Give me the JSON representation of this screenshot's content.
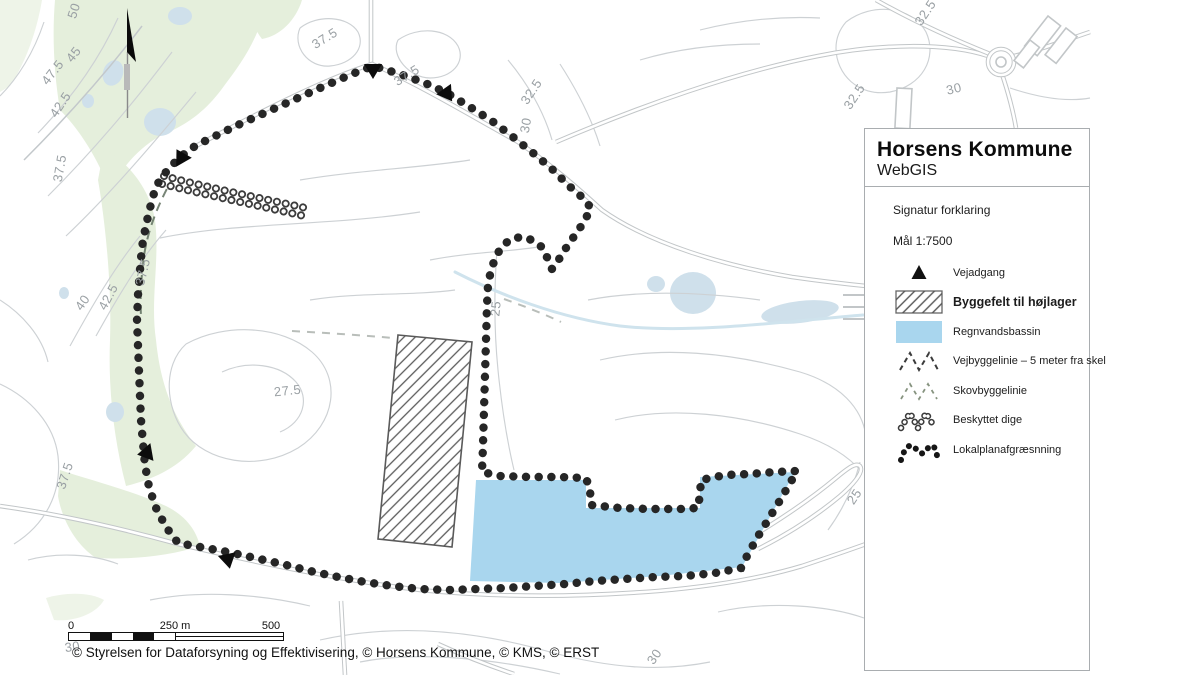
{
  "brand": {
    "title": "Horsens Kommune",
    "subtitle": "WebGIS"
  },
  "legend": {
    "section_title": "Signatur forklaring",
    "scale_label": "Mål 1:7500",
    "items": [
      {
        "icon": "road-access-triangle-icon",
        "label": "Vejadgang",
        "emphasis": false
      },
      {
        "icon": "hatched-area-icon",
        "label": "Byggefelt til højlager",
        "emphasis": true
      },
      {
        "icon": "water-swatch-icon",
        "label": "Regnvandsbassin",
        "emphasis": false
      },
      {
        "icon": "dashed-zigzag-dark-icon",
        "label": "Vejbyggelinie – 5 meter fra skel",
        "emphasis": false
      },
      {
        "icon": "dashed-zigzag-light-icon",
        "label": "Skovbyggelinie",
        "emphasis": false
      },
      {
        "icon": "ring-chain-icon",
        "label": "Beskyttet dige",
        "emphasis": false
      },
      {
        "icon": "dot-chain-icon",
        "label": "Lokalplanafgræsnning",
        "emphasis": false
      }
    ]
  },
  "scale_bar": {
    "start": "0",
    "middle": "250 m",
    "end": "500 m"
  },
  "attribution": "© Styrelsen for Dataforsyning og Effektivisering, © Horsens Kommune, © KMS, © ERST",
  "map": {
    "colors": {
      "basin": "#a9d6ee",
      "forest": "#e5efdc",
      "pond": "#cfe0eb",
      "contour": "#cdd1d4",
      "boundary": "#262626"
    },
    "contour_labels": [
      {
        "text": "50",
        "x": 78,
        "y": 12,
        "rot": -72
      },
      {
        "text": "45",
        "x": 77,
        "y": 57,
        "rot": -52
      },
      {
        "text": "47.5",
        "x": 56,
        "y": 75,
        "rot": -52
      },
      {
        "text": "42.5",
        "x": 64,
        "y": 107,
        "rot": -56
      },
      {
        "text": "37.5",
        "x": 64,
        "y": 169,
        "rot": -80
      },
      {
        "text": "37.5",
        "x": 147,
        "y": 273,
        "rot": -76
      },
      {
        "text": "42.5",
        "x": 112,
        "y": 299,
        "rot": -62
      },
      {
        "text": "40",
        "x": 86,
        "y": 305,
        "rot": -55
      },
      {
        "text": "27.5",
        "x": 288,
        "y": 395,
        "rot": -6
      },
      {
        "text": "37.5",
        "x": 69,
        "y": 477,
        "rot": -72
      },
      {
        "text": "37.5",
        "x": 327,
        "y": 42,
        "rot": -32
      },
      {
        "text": "37.5",
        "x": 409,
        "y": 79,
        "rot": -32
      },
      {
        "text": "32.5",
        "x": 535,
        "y": 94,
        "rot": -56
      },
      {
        "text": "30",
        "x": 530,
        "y": 126,
        "rot": -80
      },
      {
        "text": "25",
        "x": 500,
        "y": 309,
        "rot": -84
      },
      {
        "text": "32.5",
        "x": 929,
        "y": 15,
        "rot": -56
      },
      {
        "text": "32.5",
        "x": 858,
        "y": 99,
        "rot": -56
      },
      {
        "text": "30",
        "x": 955,
        "y": 93,
        "rot": -14
      },
      {
        "text": "25",
        "x": 858,
        "y": 499,
        "rot": -56
      },
      {
        "text": "30",
        "x": 73,
        "y": 651,
        "rot": -8
      },
      {
        "text": "30",
        "x": 658,
        "y": 659,
        "rot": -56
      }
    ]
  }
}
